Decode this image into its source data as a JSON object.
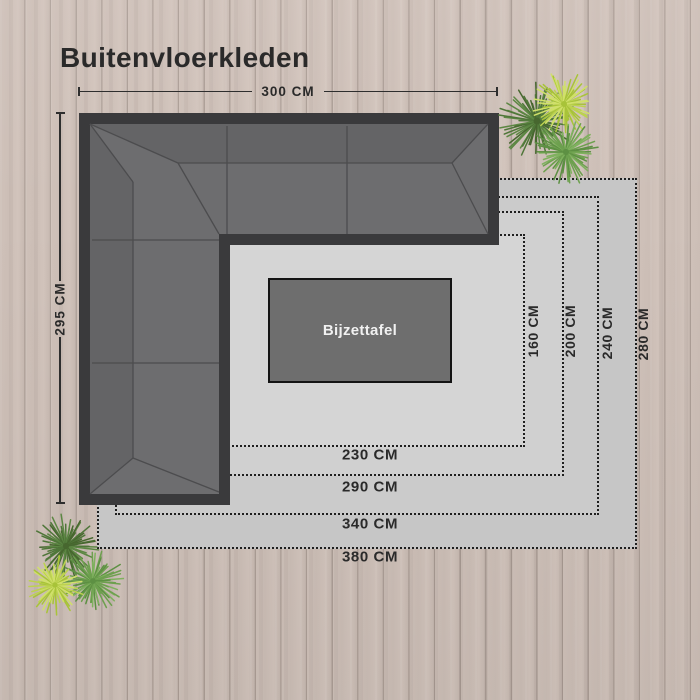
{
  "title": "Buitenvloerkleden",
  "sofa": {
    "width_label": "300 CM",
    "height_label": "295 CM"
  },
  "side_table": {
    "label": "Bijzettafel"
  },
  "rug_sizes": [
    {
      "name": "380x280",
      "width_label": "380 CM",
      "height_label": "280 CM"
    },
    {
      "name": "340x240",
      "width_label": "340 CM",
      "height_label": "240 CM"
    },
    {
      "name": "290x200",
      "width_label": "290 CM",
      "height_label": "200 CM"
    },
    {
      "name": "230x160",
      "width_label": "230 CM",
      "height_label": "160 CM"
    }
  ],
  "colors": {
    "label_text": "#2a2a2a",
    "rug_fill_outer": "#c6c6c6",
    "rug_fill_inner": "#d5d5d5",
    "sofa_frame": "#3a3a3c",
    "sofa_cushion": "#6d6d6f",
    "table_fill": "#6e6e6e",
    "wood_base": "#cbbdb5",
    "plant_dark_green": "#4f7639",
    "plant_mid_green": "#6da04e",
    "plant_yellow_green": "#bcd24f"
  }
}
